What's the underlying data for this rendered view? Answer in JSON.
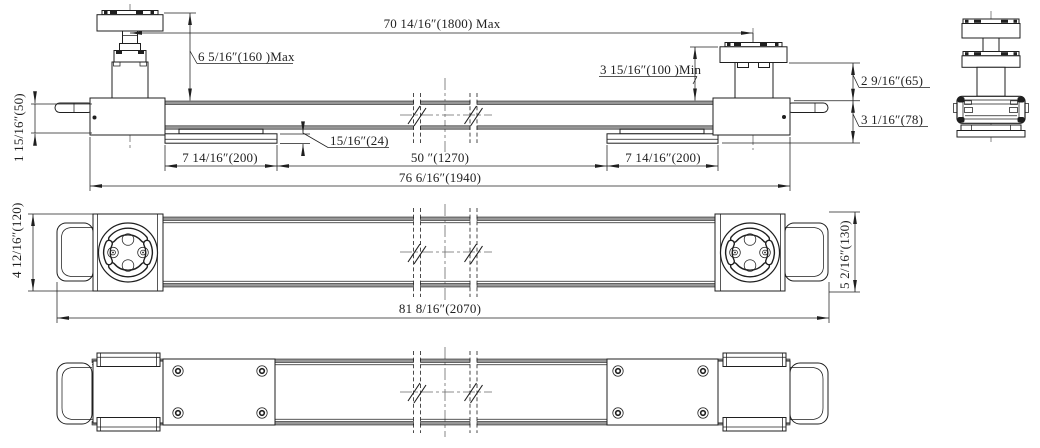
{
  "colors": {
    "line": "#1f1f1f",
    "beam_band": "#979797",
    "centerline": "#6a6a6a",
    "background": "#ffffff"
  },
  "drawing": {
    "front_view": {
      "dims": {
        "overall_span_max": "70 14/16″(1800) Max",
        "jack_height_max": "6 5/16″(160 )Max",
        "jack_height_min": "3 15/16″(100 )Min",
        "saddle_height": "2 9/16″(65)",
        "frame_height": "3 1/16″(78)",
        "handle_height": "1 15/16″(50)",
        "pad_thickness": "15/16″(24)",
        "pad_length_left": "7 14/16″(200)",
        "pad_spacing": "50 ″(1270)",
        "pad_length_right": "7 14/16″(200)",
        "overall_length": "76 6/16″(1940)"
      }
    },
    "plan_view": {
      "dims": {
        "width_left": "4 12/16″(120)",
        "width_right": "5 2/16″(130)",
        "overall_length": "81 8/16″(2070)"
      }
    }
  }
}
